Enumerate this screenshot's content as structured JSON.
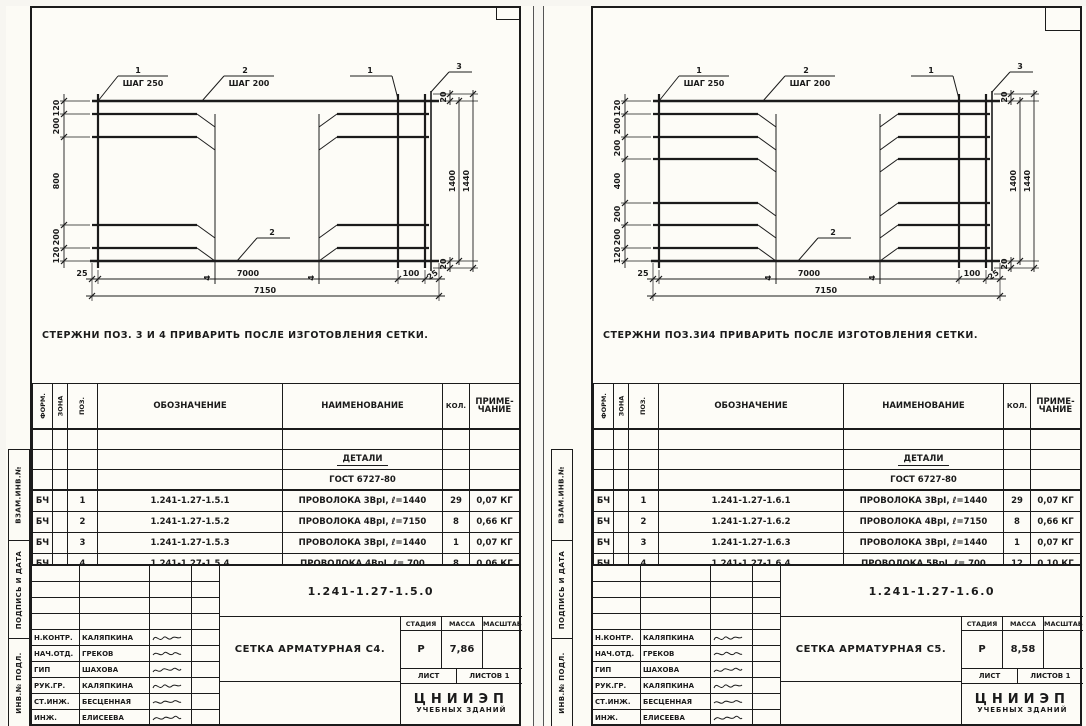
{
  "left": {
    "stamp": [
      "ВЗАМ.ИНВ.№",
      "ПОДПИСЬ И ДАТА",
      "ИНВ.№ ПОДЛ."
    ],
    "drawing": {
      "c1_num": "1",
      "c1_text": "ШАГ 250",
      "c2_num": "2",
      "c2_text": "ШАГ 200",
      "c1r": "1",
      "c3": "3",
      "c2b": "2",
      "c4a": "4",
      "c4b": "4",
      "dims_left": [
        "120",
        "200",
        "800",
        "200",
        "120"
      ],
      "d20t": "20",
      "d1400": "1400",
      "d1440": "1440",
      "d20b": "20",
      "db": [
        "25",
        "7000",
        "100",
        "25"
      ],
      "total": "7150"
    },
    "note": "СТЕРЖНИ ПОЗ. 3 И 4 ПРИВАРИТЬ ПОСЛЕ ИЗГОТОВЛЕНИЯ СЕТКИ.",
    "table": {
      "h_form": "ФОРМ.",
      "h_zona": "ЗОНА",
      "h_poz": "ПОЗ.",
      "h_oboz": "ОБОЗНАЧЕНИЕ",
      "h_naim": "НАИМЕНОВАНИЕ",
      "h_kol": "КОЛ.",
      "h_prim1": "ПРИМЕ-",
      "h_prim2": "ЧАНИЕ",
      "group_title": "ДЕТАЛИ",
      "gost": "ГОСТ 6727-80",
      "rows": [
        {
          "form": "БЧ",
          "poz": "1",
          "oboz": "1.241-1.27-1.5.1",
          "naim": "ПРОВОЛОКА 3ВрI, ℓ=1440",
          "kol": "29",
          "prim": "0,07 КГ"
        },
        {
          "form": "БЧ",
          "poz": "2",
          "oboz": "1.241-1.27-1.5.2",
          "naim": "ПРОВОЛОКА 4ВрI, ℓ=7150",
          "kol": "8",
          "prim": "0,66 КГ"
        },
        {
          "form": "БЧ",
          "poz": "3",
          "oboz": "1.241-1.27-1.5.3",
          "naim": "ПРОВОЛОКА 3ВрI, ℓ=1440",
          "kol": "1",
          "prim": "0,07 КГ"
        },
        {
          "form": "БЧ",
          "poz": "4",
          "oboz": "1.241-1.27-1.5.4",
          "naim": "ПРОВОЛОКА 4ВрI, ℓ= 700",
          "kol": "8",
          "prim": "0,06 КГ"
        }
      ]
    },
    "tb": {
      "doc": "1.241-1.27-1.5.0",
      "title": "СЕТКА АРМАТУРНАЯ С4.",
      "stage_h": "СТАДИЯ",
      "mass_h": "МАССА",
      "scale_h": "МАСШТАБ",
      "stage": "Р",
      "mass": "7,86",
      "scale": "",
      "list_h": "ЛИСТ",
      "listov": "ЛИСТОВ 1",
      "org1": "ЦНИИЭП",
      "org2": "УЧЕБНЫХ ЗДАНИЙ",
      "people": [
        {
          "role": "Н.КОНТР.",
          "name": "КАЛЯПКИНА"
        },
        {
          "role": "НАЧ.ОТД.",
          "name": "ГРЕКОВ"
        },
        {
          "role": "ГИП",
          "name": "ШАХОВА"
        },
        {
          "role": "РУК.ГР.",
          "name": "КАЛЯПКИНА"
        },
        {
          "role": "СТ.ИНЖ.",
          "name": "БЕСЦЕННАЯ"
        },
        {
          "role": "ИНЖ.",
          "name": "ЕЛИСЕЕВА"
        }
      ]
    }
  },
  "right": {
    "stamp": [
      "ВЗАМ.ИНВ.№",
      "ПОДПИСЬ И ДАТА",
      "ИНВ.№ ПОДЛ."
    ],
    "drawing": {
      "c1_num": "1",
      "c1_text": "ШАГ 250",
      "c2_num": "2",
      "c2_text": "ШАГ 200",
      "c1r": "1",
      "c3": "3",
      "c2b": "2",
      "c4a": "4",
      "c4b": "4",
      "dims_left": [
        "120",
        "200",
        "200",
        "400",
        "200",
        "200",
        "120"
      ],
      "d20t": "20",
      "d1400": "1400",
      "d1440": "1440",
      "d20b": "20",
      "db": [
        "25",
        "7000",
        "100",
        "25"
      ],
      "total": "7150"
    },
    "note": "СТЕРЖНИ ПОЗ.3И4 ПРИВАРИТЬ ПОСЛЕ ИЗГОТОВЛЕНИЯ СЕТКИ.",
    "table": {
      "h_form": "ФОРМ.",
      "h_zona": "ЗОНА",
      "h_poz": "ПОЗ.",
      "h_oboz": "ОБОЗНАЧЕНИЕ",
      "h_naim": "НАИМЕНОВАНИЕ",
      "h_kol": "КОЛ.",
      "h_prim1": "ПРИМЕ-",
      "h_prim2": "ЧАНИЕ",
      "group_title": "ДЕТАЛИ",
      "gost": "ГОСТ 6727-80",
      "rows": [
        {
          "form": "БЧ",
          "poz": "1",
          "oboz": "1.241-1.27-1.6.1",
          "naim": "ПРОВОЛОКА 3ВрI, ℓ=1440",
          "kol": "29",
          "prim": "0,07 КГ"
        },
        {
          "form": "БЧ",
          "poz": "2",
          "oboz": "1.241-1.27-1.6.2",
          "naim": "ПРОВОЛОКА 4ВрI, ℓ=7150",
          "kol": "8",
          "prim": "0,66 КГ"
        },
        {
          "form": "БЧ",
          "poz": "3",
          "oboz": "1.241-1.27-1.6.3",
          "naim": "ПРОВОЛОКА 3ВрI, ℓ=1440",
          "kol": "1",
          "prim": "0,07 КГ"
        },
        {
          "form": "БЧ",
          "poz": "4",
          "oboz": "1.241-1.27-1.6.4",
          "naim": "ПРОВОЛОКА 5ВрI, ℓ= 700",
          "kol": "12",
          "prim": "0,10 КГ"
        }
      ]
    },
    "tb": {
      "doc": "1.241-1.27-1.6.0",
      "title": "СЕТКА АРМАТУРНАЯ С5.",
      "stage_h": "СТАДИЯ",
      "mass_h": "МАССА",
      "scale_h": "МАСШТАБ",
      "stage": "Р",
      "mass": "8,58",
      "scale": "",
      "list_h": "ЛИСТ",
      "listov": "ЛИСТОВ 1",
      "org1": "ЦНИИЭП",
      "org2": "УЧЕБНЫХ ЗДАНИЙ",
      "people": [
        {
          "role": "Н.КОНТР.",
          "name": "КАЛЯПКИНА"
        },
        {
          "role": "НАЧ.ОТД.",
          "name": "ГРЕКОВ"
        },
        {
          "role": "ГИП",
          "name": "ШАХОВА"
        },
        {
          "role": "РУК.ГР.",
          "name": "КАЛЯПКИНА"
        },
        {
          "role": "СТ.ИНЖ.",
          "name": "БЕСЦЕННАЯ"
        },
        {
          "role": "ИНЖ.",
          "name": "ЕЛИСЕЕВА"
        }
      ]
    }
  }
}
